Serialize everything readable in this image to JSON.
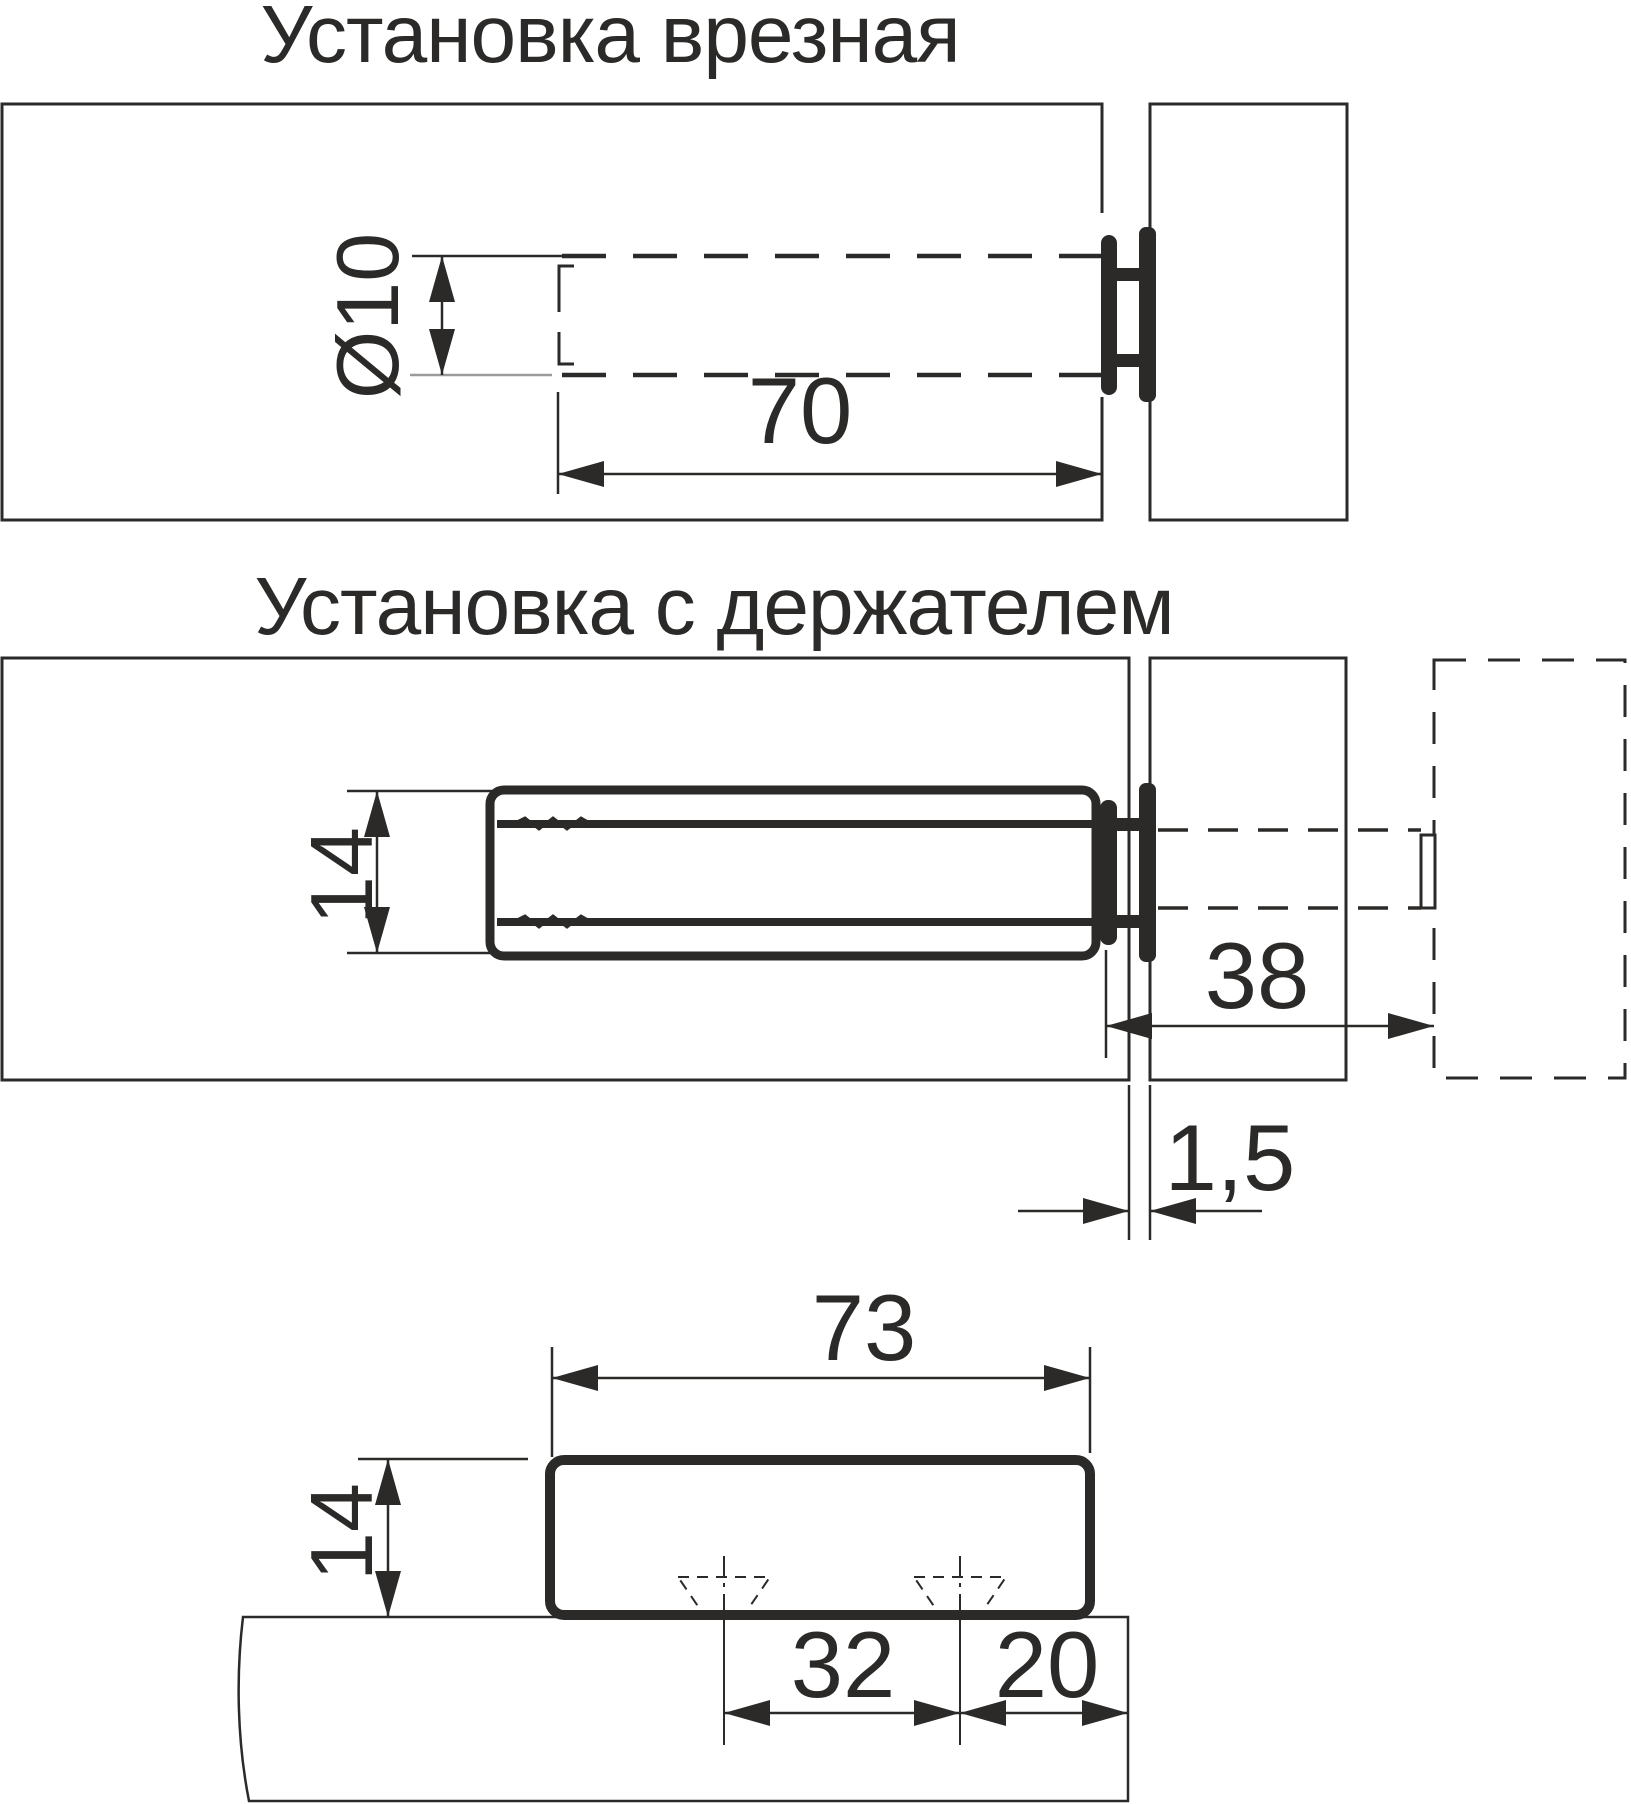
{
  "page": {
    "background": "#ffffff",
    "ink": "#2b2a29",
    "light_line": "#9a9a9a"
  },
  "titles": {
    "mortise": "Установка врезная",
    "holder": "Установка с держателем"
  },
  "dimensions": {
    "hole_diameter": "Ø10",
    "hole_depth": "70",
    "body_height": "14",
    "protrusion": "38",
    "door_gap": "1,5",
    "body_length": "73",
    "side_height": "14",
    "screw_spacing": "32",
    "edge_offset": "20"
  }
}
